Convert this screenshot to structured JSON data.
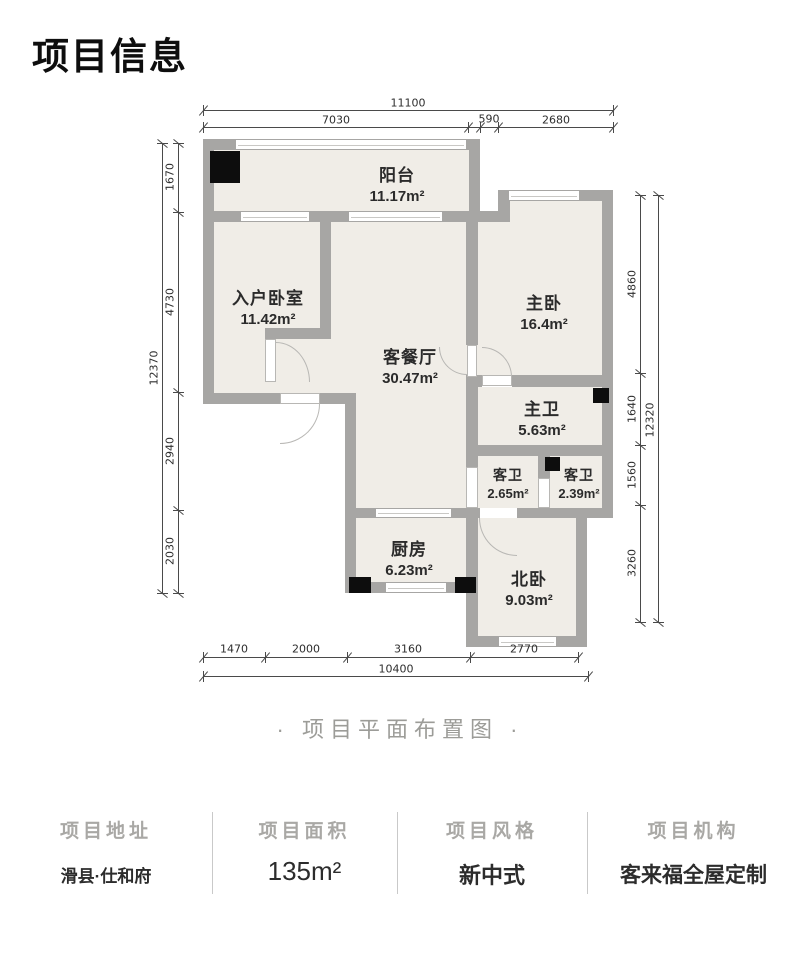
{
  "page": {
    "title": "项目信息",
    "caption": "· 项目平面布置图 ·"
  },
  "rooms": [
    {
      "id": "balcony",
      "name": "阳台",
      "area": "11.17m²"
    },
    {
      "id": "entry-bedroom",
      "name": "入户卧室",
      "area": "11.42m²"
    },
    {
      "id": "living-dining",
      "name": "客餐厅",
      "area": "30.47m²"
    },
    {
      "id": "master-bedroom",
      "name": "主卧",
      "area": "16.4m²"
    },
    {
      "id": "master-bath",
      "name": "主卫",
      "area": "5.63m²"
    },
    {
      "id": "guest-bath-1",
      "name": "客卫",
      "area": "2.65m²"
    },
    {
      "id": "guest-bath-2",
      "name": "客卫",
      "area": "2.39m²"
    },
    {
      "id": "kitchen",
      "name": "厨房",
      "area": "6.23m²"
    },
    {
      "id": "north-bedroom",
      "name": "北卧",
      "area": "9.03m²"
    }
  ],
  "dimensions": {
    "top": {
      "total": "11100",
      "segments": [
        "7030",
        "590",
        "2680"
      ]
    },
    "left": {
      "total": "12370",
      "segments": [
        "1670",
        "4730",
        "2940",
        "2030"
      ]
    },
    "right": {
      "total": "12320",
      "segments": [
        "4860",
        "1640",
        "1560",
        "3260"
      ]
    },
    "bottom": {
      "total": "10400",
      "segments": [
        "1470",
        "2000",
        "3160",
        "2770"
      ]
    }
  },
  "info": {
    "columns": [
      {
        "label": "项目地址",
        "value": "滑县·仕和府"
      },
      {
        "label": "项目面积",
        "value": "135m²"
      },
      {
        "label": "项目风格",
        "value": "新中式"
      },
      {
        "label": "项目机构",
        "value": "客来福全屋定制"
      }
    ]
  },
  "colors": {
    "wall": "#a7a6a4",
    "floor": "#f0ede7",
    "dim_line": "#4a4a4a",
    "muted_text": "#a9a8a5"
  }
}
